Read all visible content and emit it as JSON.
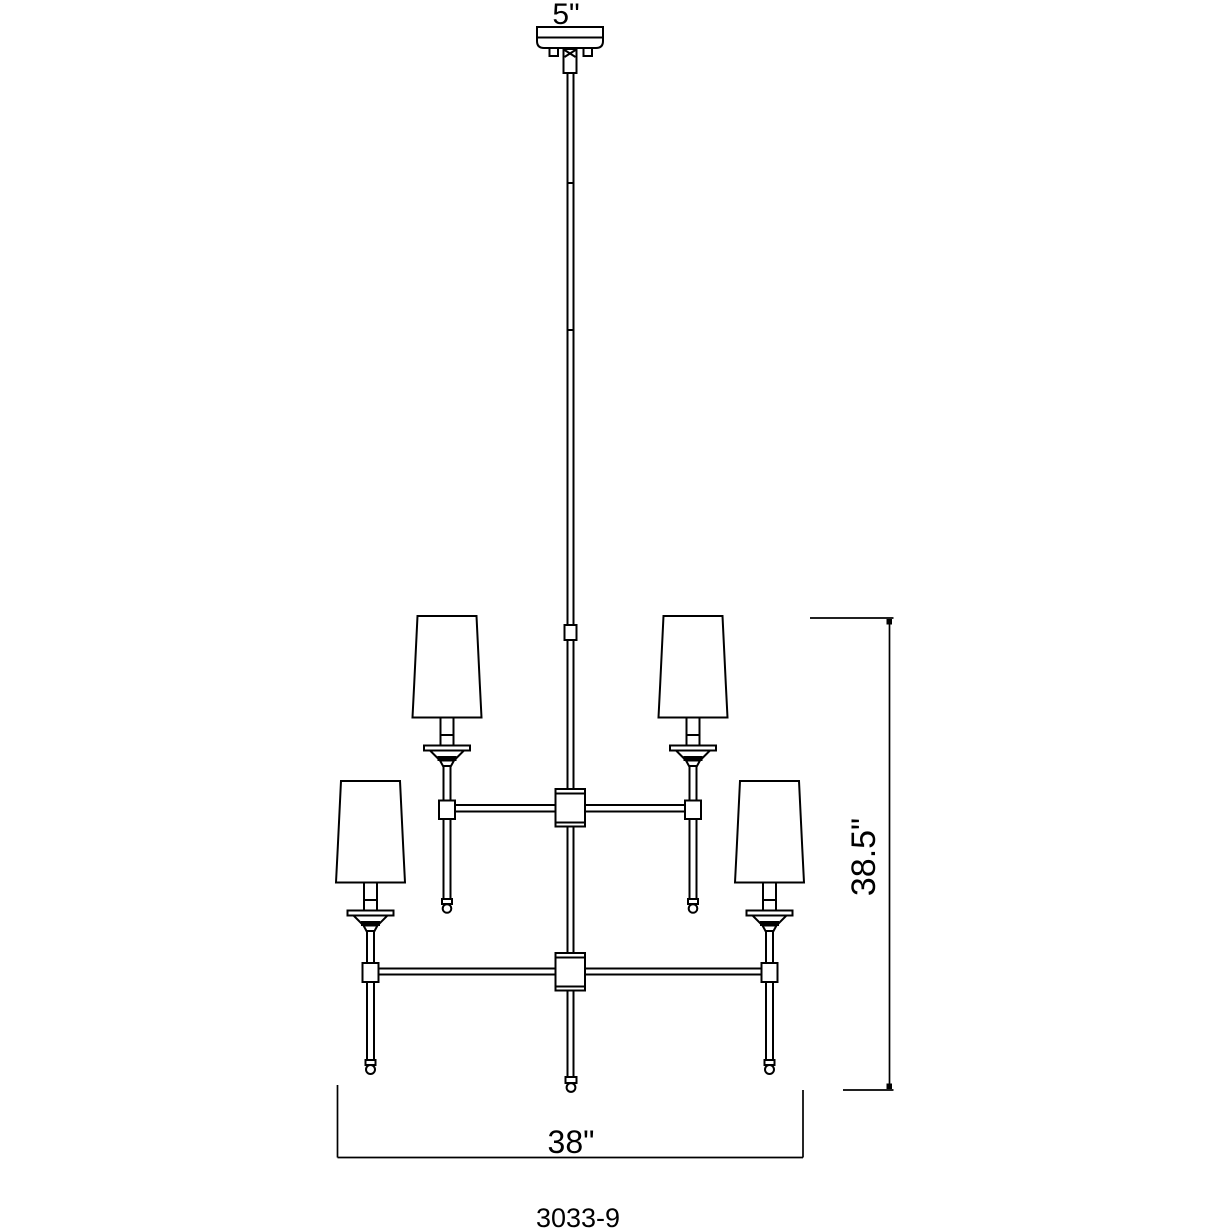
{
  "drawing": {
    "type": "chandelier-dimension-drawing",
    "model_number": "3033-9",
    "dimensions": {
      "canopy_width_label": "5\"",
      "fixture_height_label": "38.5\"",
      "fixture_width_label": "38\""
    },
    "style": {
      "line_color": "#000000",
      "background_color": "#ffffff"
    },
    "structure": {
      "tiers": 2,
      "shades_visible": 4,
      "ceiling_mount": "canopy with downrod"
    }
  }
}
